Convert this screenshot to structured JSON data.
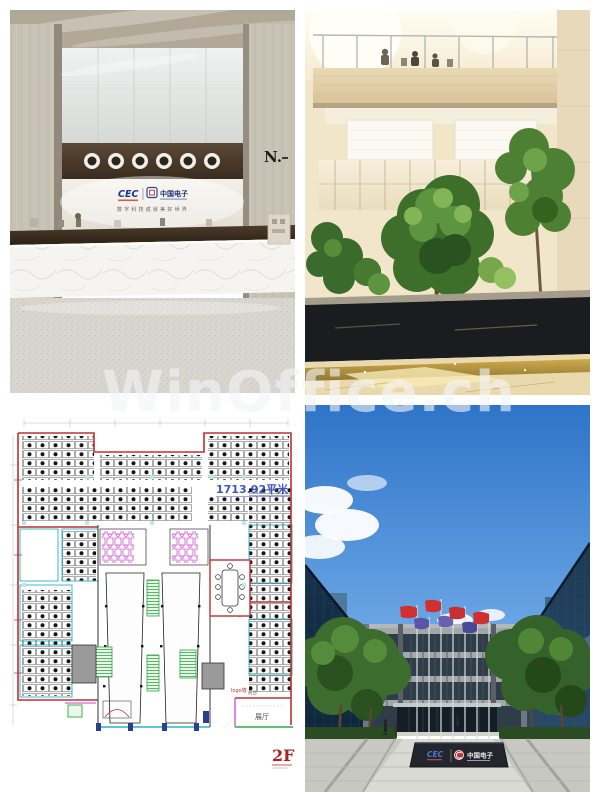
{
  "watermark": {
    "text": "WinOffice.ch"
  },
  "lobby": {
    "wall_letter": "N.",
    "logo_cec": "CEC",
    "logo_partner": "中国电子",
    "tagline": "数字科技成就美好世界"
  },
  "floor_plan": {
    "area_label": "1713.92平米",
    "floor_label": "2F",
    "logo_wall_label": "logo墙",
    "reception_label": "前台",
    "exhibition_label": "展厅"
  },
  "building": {
    "sign_cec": "CEC",
    "sign_partner": "中国电子"
  },
  "colors": {
    "plan_wall_red": "#c03030",
    "plan_cyan": "#2ab4c4",
    "plan_green": "#2ea843",
    "plan_magenta": "#c83cc8",
    "plan_area_blue": "#3c55c8",
    "sky_blue": "#3a7fd5",
    "cec_blue": "#16368f",
    "flag_red": "#d03030",
    "flag_purple": "#5a55a8"
  }
}
